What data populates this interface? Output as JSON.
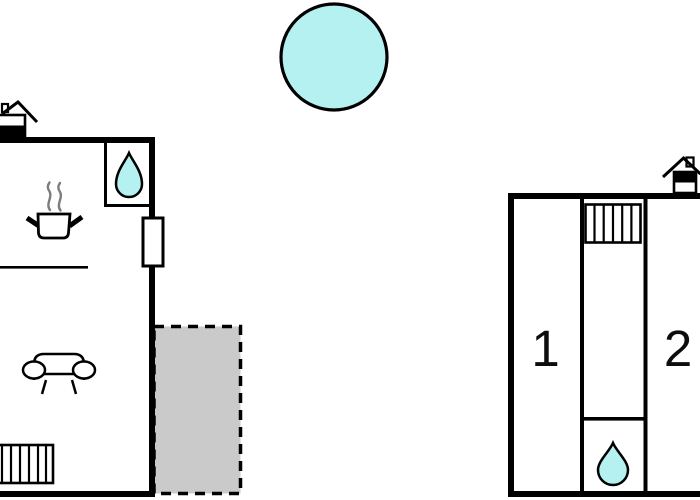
{
  "app": {
    "type": "holiday-home-floor-plan",
    "background": "#ffffff"
  },
  "colors": {
    "wall": "#000000",
    "outline": "#0a0a0a",
    "water_fill": "#b5f1f1",
    "terrace_fill": "#cacaca",
    "steam_stroke": "#7d7d7d",
    "label_text": "#0d0d0d",
    "white": "#ffffff"
  },
  "pool": {
    "icon": "pool-circle-icon"
  },
  "left_building": {
    "name": "main-house",
    "icons": {
      "entrance": "house-entrance-icon",
      "shower": "water-drop-icon",
      "stove": "stove-pot-icon",
      "steam": "steam-icon",
      "window": "window-icon",
      "sofa": "sofa-icon",
      "stairs": "stairs-icon"
    }
  },
  "terrace": {
    "name": "terrace-area",
    "style": "dashed-outline"
  },
  "right_building": {
    "name": "annex",
    "icons": {
      "entrance": "house-entrance-icon",
      "stairs": "stairs-icon",
      "shower": "water-drop-icon"
    },
    "rooms": [
      {
        "label": "1"
      },
      {
        "label": "2"
      }
    ]
  }
}
